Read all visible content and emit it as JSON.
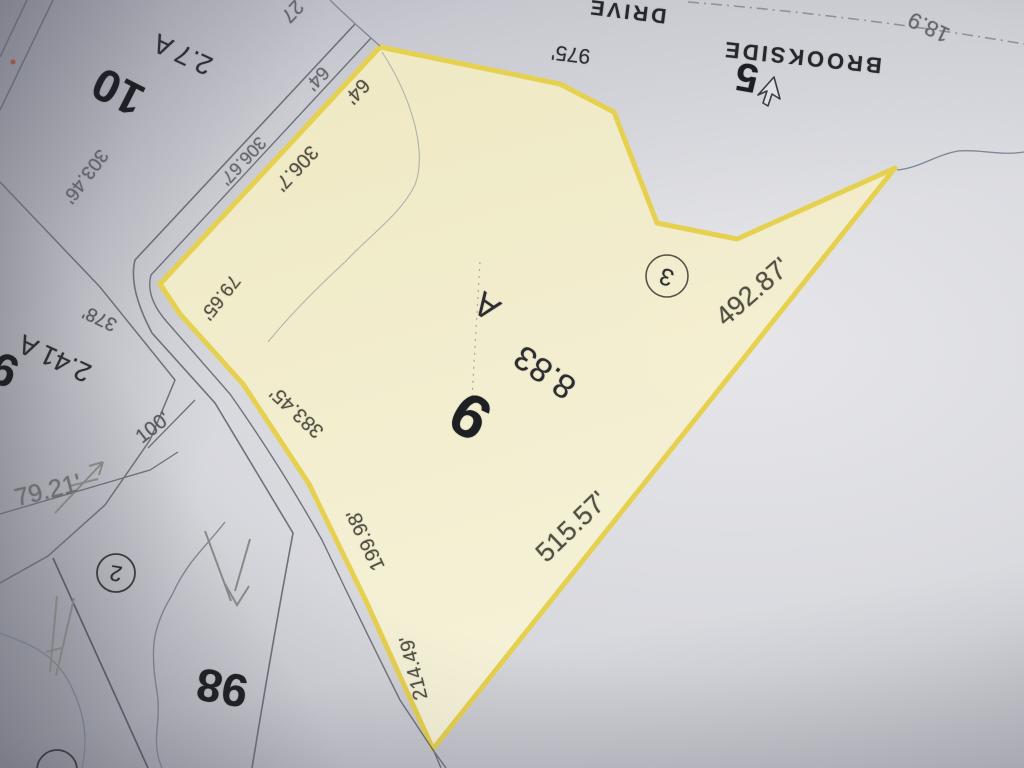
{
  "document": {
    "type": "photographed paper tax map, rotated upside-down",
    "highlighted_parcel": {
      "lot_number": "9",
      "area": "8.83 A"
    }
  },
  "colors": {
    "paper": "#d7d8dd",
    "parcel_fill": "#f3eecb",
    "parcel_boundary": "#e7d04b",
    "map_line": "#6d7179",
    "stream_line": "#7e8795",
    "print_ink": "#2b2d31",
    "dimension_ink": "#514f42",
    "pencil": "#8b8b87"
  },
  "annotations": {
    "pencil_marks": [
      "pencil-arrow-left",
      "pencil-arrow-mid",
      "pencil-arrow-bottom-left"
    ],
    "cursor": "arrow-pointer"
  },
  "map": {
    "labels": [
      {
        "name": "street-label-drive",
        "text": "DRIVE"
      },
      {
        "name": "street-label-brookside",
        "text": "BROOKSIDE"
      },
      {
        "name": "lot-number-5",
        "text": "5"
      },
      {
        "name": "dimension-18-9",
        "text": "18.9"
      },
      {
        "name": "dimension-27",
        "text": "27"
      },
      {
        "name": "dimension-975",
        "text": "975'"
      },
      {
        "name": "lot-number-10",
        "text": "10"
      },
      {
        "name": "area-label-2-7-a",
        "text": "2.7 A"
      },
      {
        "name": "dimension-303-46",
        "text": "303.46'"
      },
      {
        "name": "dimension-306-67",
        "text": "306.67'"
      },
      {
        "name": "dimension-306-7",
        "text": "306.7'"
      },
      {
        "name": "dimension-64-outer",
        "text": "64'"
      },
      {
        "name": "dimension-64-inner",
        "text": "64'"
      },
      {
        "name": "dimension-79-65",
        "text": "79.65'"
      },
      {
        "name": "dimension-378",
        "text": "378'"
      },
      {
        "name": "area-label-2-41-a",
        "text": "2.41 A"
      },
      {
        "name": "lot-number-9-partial",
        "text": "9"
      },
      {
        "name": "dimension-100",
        "text": "100'"
      },
      {
        "name": "dimension-79-21",
        "text": "79.21'"
      },
      {
        "name": "point-marker-2",
        "text": "2"
      },
      {
        "name": "lot-number-98",
        "text": "98"
      },
      {
        "name": "dimension-383-45",
        "text": "383.45'"
      },
      {
        "name": "dimension-199-98",
        "text": "199.98'"
      },
      {
        "name": "dimension-214-49",
        "text": "214.49'"
      },
      {
        "name": "lot-number-9",
        "text": "9"
      },
      {
        "name": "area-label-8-83",
        "text": "8.83"
      },
      {
        "name": "area-label-acres-a",
        "text": "A"
      },
      {
        "name": "point-marker-3",
        "text": "3"
      },
      {
        "name": "dimension-492-87",
        "text": "492.87'"
      },
      {
        "name": "dimension-515-57",
        "text": "515.57'"
      }
    ]
  }
}
